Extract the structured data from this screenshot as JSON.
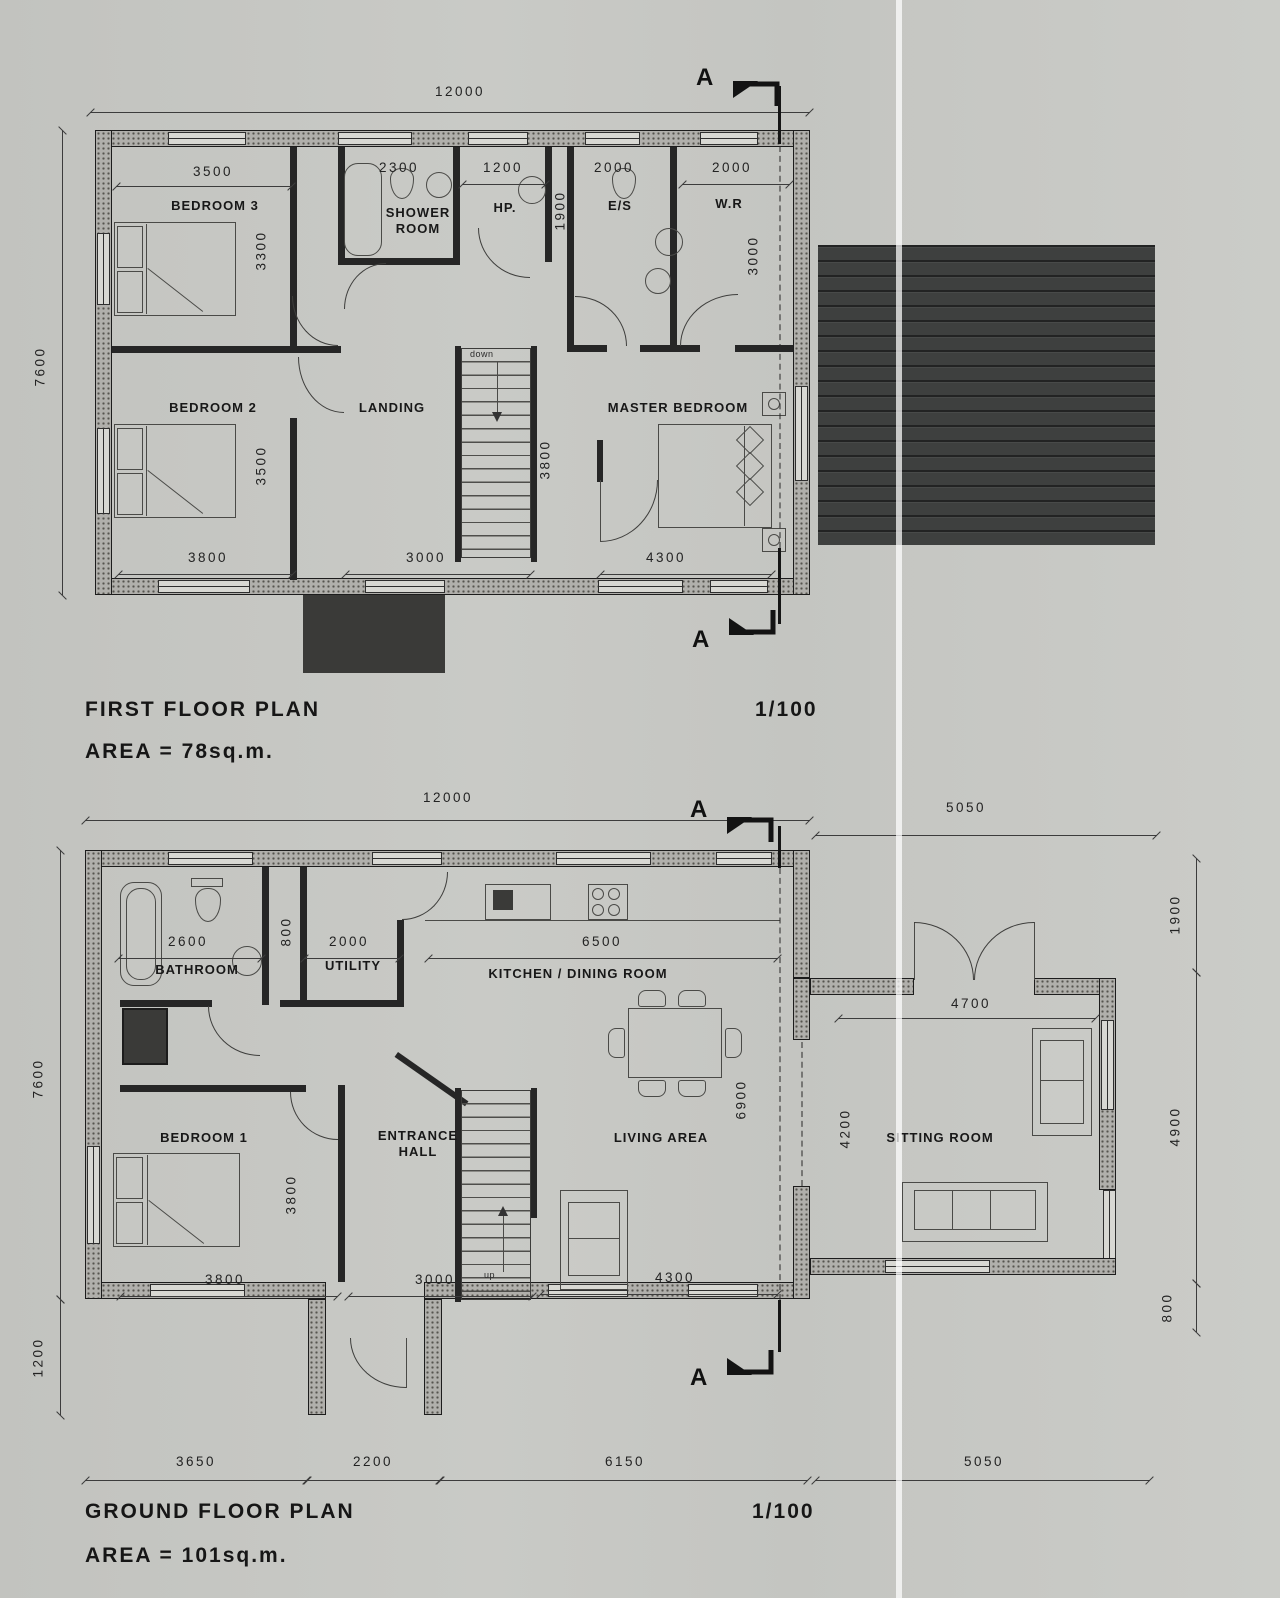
{
  "first_floor": {
    "title": "FIRST FLOOR PLAN",
    "area_label": "AREA = 78sq.m.",
    "scale": "1/100",
    "section_letter": "A",
    "stair_direction": "down",
    "rooms": {
      "bedroom3": "BEDROOM 3",
      "shower_room": "SHOWER ROOM",
      "hot_press": "HP.",
      "ensuite": "E/S",
      "walk_in_robe": "W.R",
      "bedroom2": "BEDROOM 2",
      "landing": "LANDING",
      "master_bedroom": "MASTER BEDROOM"
    },
    "dims": {
      "overall_width": "12000",
      "overall_depth": "7600",
      "bedroom3_width": "3500",
      "bedroom3_depth": "3300",
      "shower_width": "2300",
      "hot_press_width": "1200",
      "corridor_depth": "1900",
      "ensuite_width": "2000",
      "walk_in_robe_width": "2000",
      "walk_in_robe_depth": "3000",
      "bedroom2_depth": "3500",
      "bedroom2_width": "3800",
      "landing_width": "3000",
      "stair_depth": "3800",
      "master_width": "4300"
    }
  },
  "ground_floor": {
    "title": "GROUND FLOOR PLAN",
    "area_label": "AREA = 101sq.m.",
    "scale": "1/100",
    "section_letter": "A",
    "stair_direction": "up",
    "rooms": {
      "bathroom": "BATHROOM",
      "utility": "UTILITY",
      "kitchen_dining": "KITCHEN / DINING ROOM",
      "bedroom1": "BEDROOM 1",
      "entrance_hall": "ENTRANCE HALL",
      "living_area": "LIVING AREA",
      "sitting_room": "SITTING ROOM"
    },
    "dims": {
      "overall_width": "12000",
      "extension_width": "5050",
      "overall_depth": "7600",
      "porch_depth": "1200",
      "right_top": "1900",
      "right_middle": "4900",
      "right_bottom": "800",
      "bathroom_width": "2600",
      "lobby_width": "800",
      "utility_width": "2000",
      "kitchen_width": "6500",
      "living_depth": "6900",
      "bedroom1_depth": "3800",
      "bedroom1_width": "3800",
      "hall_width": "3000",
      "living_width": "4300",
      "sitting_width": "4700",
      "opening_width": "4200",
      "bottom_seg1": "3650",
      "bottom_seg2": "2200",
      "bottom_seg3": "6150",
      "bottom_seg4": "5050"
    }
  }
}
